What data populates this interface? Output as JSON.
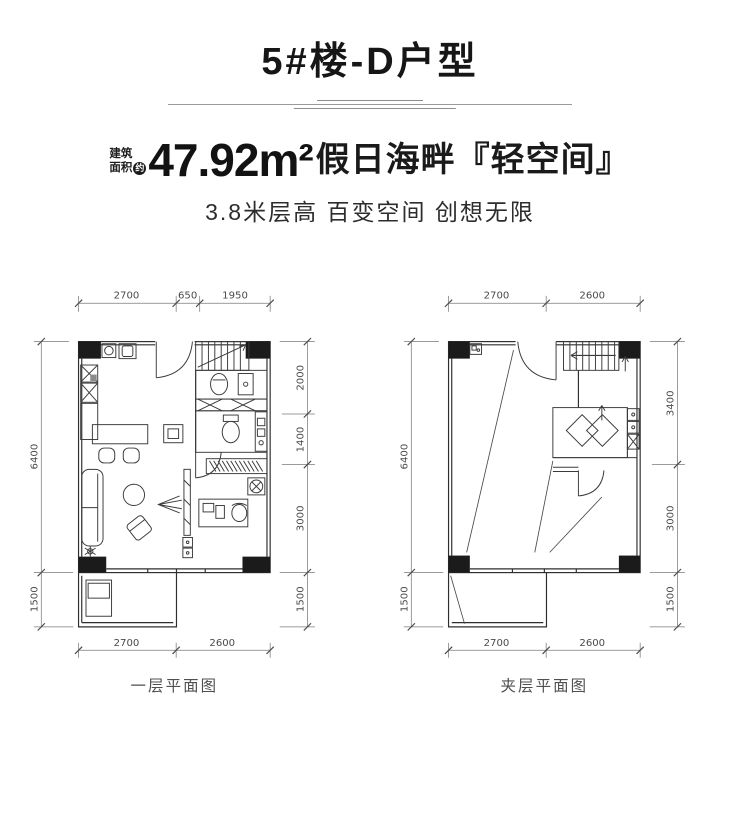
{
  "header": {
    "title": "5#楼-D户型",
    "area_label_top": "建筑",
    "area_label_bottom": "面积",
    "area_approx_badge": "约",
    "area_value": "47.92m²",
    "headline_suffix": "假日海畔『轻空间』",
    "subtitle": "3.8米层高 百变空间 创想无限"
  },
  "plans": [
    {
      "caption": "一层平面图",
      "top": [
        "2700",
        "650",
        "1950"
      ],
      "left": [
        "6400",
        "1500"
      ],
      "right": [
        "2000",
        "1400",
        "3000",
        "1500"
      ],
      "bottom": [
        "2700",
        "2600"
      ]
    },
    {
      "caption": "夹层平面图",
      "top": [
        "2700",
        "2600"
      ],
      "left": [
        "6400",
        "1500"
      ],
      "right": [
        "3400",
        "3000",
        "1500"
      ],
      "bottom": [
        "2700",
        "2600"
      ]
    }
  ]
}
